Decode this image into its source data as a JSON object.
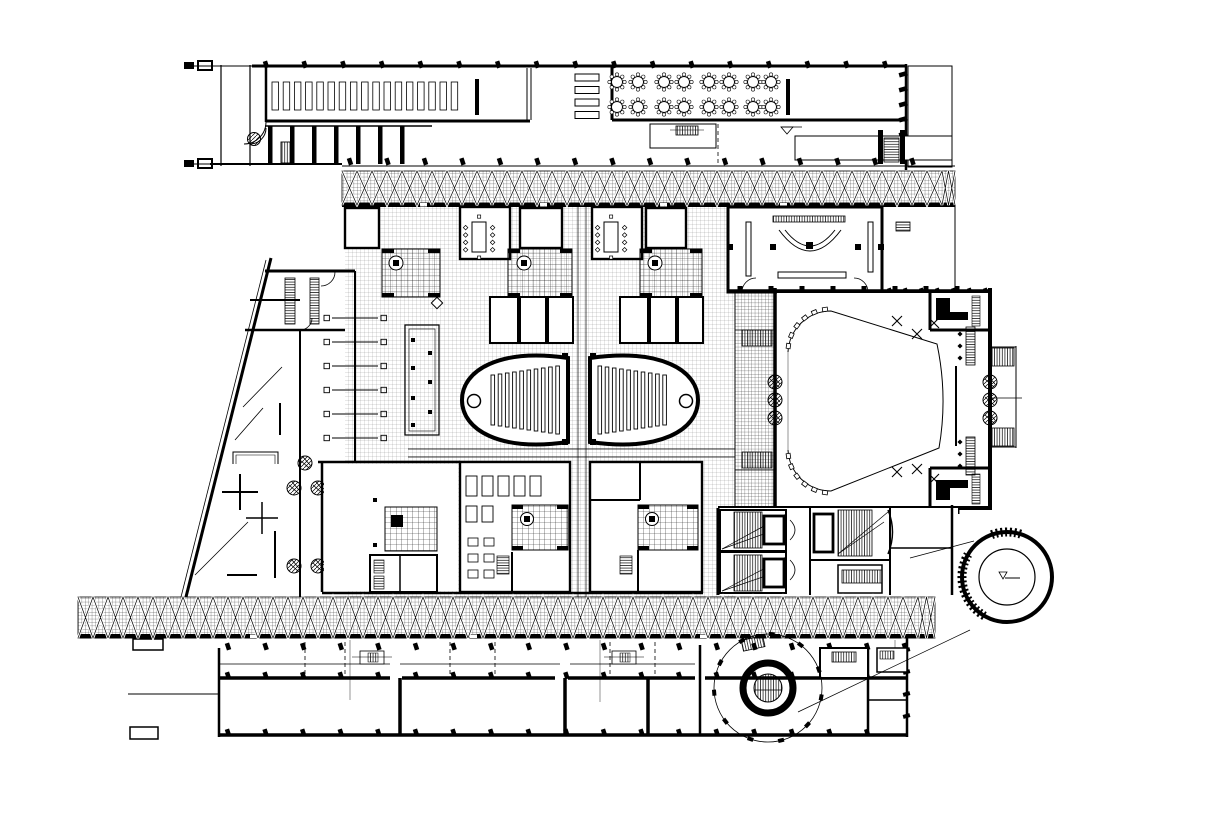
{
  "drawing": {
    "title": "",
    "colors": {
      "ink": "#000000",
      "paper": "#ffffff"
    },
    "regions": [
      {
        "name": "upper-wing",
        "desc": "long top wing with shelf stacks, serving counters and round banquet tables"
      },
      {
        "name": "skylight-band-top",
        "desc": "cross-braced hatched gallery band"
      },
      {
        "name": "entrance-plaza",
        "desc": "sloped entrance side with ramps, benches and cross markers"
      },
      {
        "name": "central-block",
        "desc": "meeting rooms, gridded courtyards with columns, service rooms"
      },
      {
        "name": "twin-lecture-halls",
        "desc": "pair of oval lecture halls with tiered seat rows"
      },
      {
        "name": "main-auditorium",
        "desc": "large hall with rounded stage boundary, side ladders and exterior stairs"
      },
      {
        "name": "stair-elevator-zone",
        "desc": "escalator and elevator cores below the hall"
      },
      {
        "name": "skylight-band-bottom",
        "desc": "cross-braced hatched gallery band"
      },
      {
        "name": "lower-wing",
        "desc": "row of rooms along the bottom edge"
      },
      {
        "name": "spiral-stair",
        "desc": "circular stair with ring wall and column ring"
      },
      {
        "name": "detail-callout",
        "desc": "enlarged detail circle tied back with leader lines"
      }
    ]
  }
}
